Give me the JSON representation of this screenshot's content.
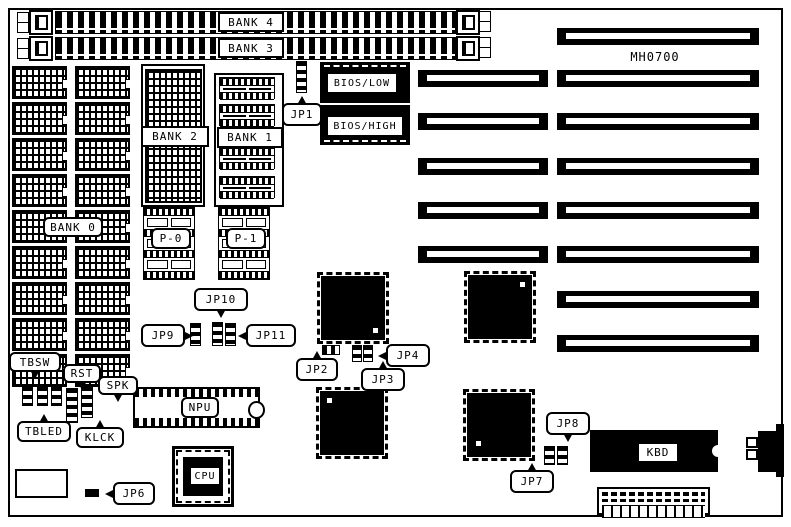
{
  "board": {
    "model_label": "MH0700"
  },
  "memory": {
    "simm_slots": [
      {
        "label": "BANK 4"
      },
      {
        "label": "BANK 3"
      }
    ],
    "bank0_label": "BANK 0",
    "bank1_label": "BANK 1",
    "bank2_label": "BANK 2",
    "parity_chips": [
      {
        "label": "P-0"
      },
      {
        "label": "P-1"
      }
    ]
  },
  "rom": {
    "low_label": "BIOS/LOW",
    "high_label": "BIOS/HIGH"
  },
  "chips": {
    "npu_label": "NPU",
    "cpu_label": "CPU",
    "kbd_label": "KBD"
  },
  "jumpers": {
    "jp1": "JP1",
    "jp2": "JP2",
    "jp3": "JP3",
    "jp4": "JP4",
    "jp6": "JP6",
    "jp7": "JP7",
    "jp8": "JP8",
    "jp9": "JP9",
    "jp10": "JP10",
    "jp11": "JP11"
  },
  "front_panel": {
    "tbsw": "TBSW",
    "rst": "RST",
    "spk": "SPK",
    "tbled": "TBLED",
    "klck": "KLCK"
  }
}
